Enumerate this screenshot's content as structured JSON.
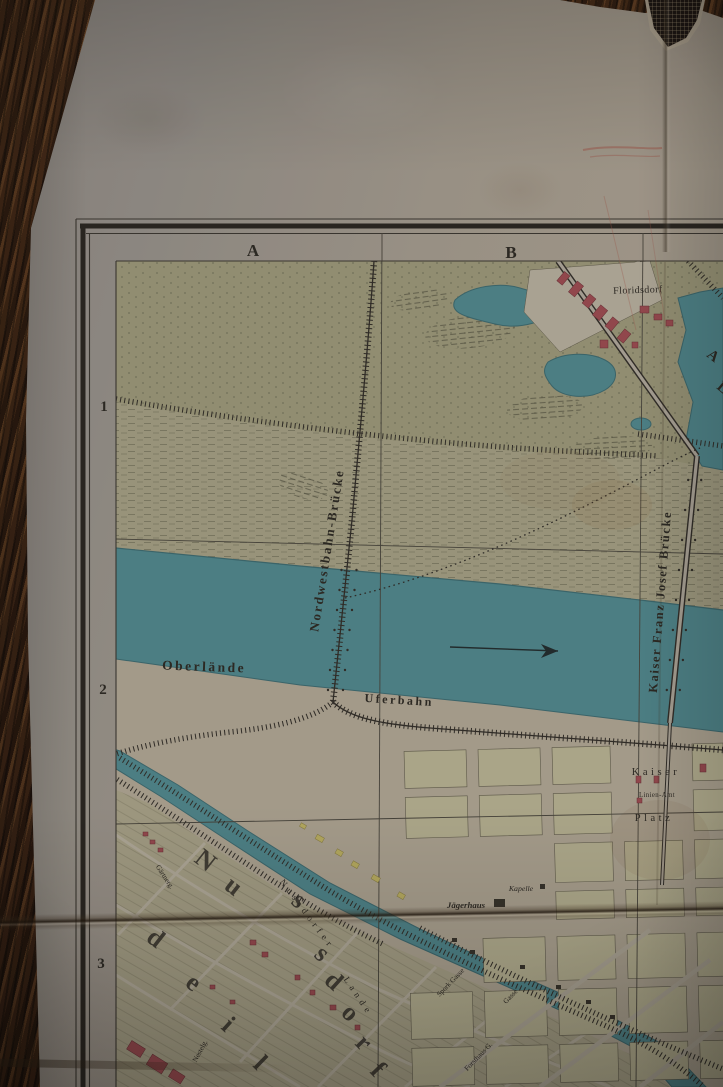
{
  "map": {
    "grid": {
      "cols": [
        "A",
        "B"
      ],
      "rows": [
        "1",
        "2",
        "3"
      ]
    },
    "labels": {
      "floridsdorf": "Floridsdorf",
      "nordwestbahn": "Nordwestbahn-Brücke",
      "kfj_bruecke": "Kaiser Franz Josef Brücke",
      "oberlaende": "Oberlände",
      "uferbahn": "Uferbahn",
      "lande_1": "Nussdorfer",
      "lande_2": "Lande",
      "kaiser": "Kaiser",
      "linien_amt": "Linien-Amt",
      "platz": "Platz",
      "kapelle": "Kapelle",
      "jaegerhaus": "Jägerhaus"
    },
    "big_letters": [
      "N",
      "u",
      "s",
      "s",
      "d",
      "o",
      "r",
      "f"
    ],
    "big_letters_partial": [
      "d",
      "e",
      "i",
      "l"
    ],
    "water_letters": [
      "A",
      "L"
    ],
    "streets": [
      "Gärtnerg.",
      "Spork Gasse",
      "Gasse",
      "Forsthaus G.",
      "Nestelg."
    ],
    "colors": {
      "river": "#4d868d",
      "terrain": "#9a9779",
      "blocks": "#b6b192",
      "building_red": "#9a4950",
      "building_yellow": "#bdb162",
      "ink": "#2e2b26",
      "paper": "#a39a8d",
      "wood": "#311d10"
    }
  }
}
